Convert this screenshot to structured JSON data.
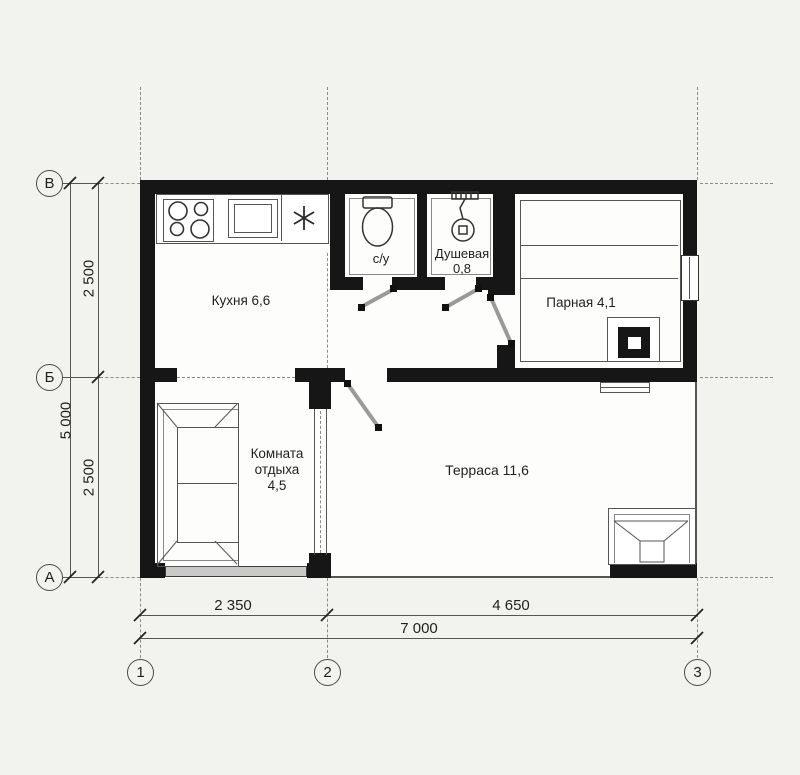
{
  "colors": {
    "wall": "#161616",
    "line": "#555555",
    "bg": "#f2f2ef",
    "paper": "#fdfdfc",
    "ink": "#1f1f1f",
    "glass": "#c9c9c6"
  },
  "rooms": {
    "kitchen": {
      "label": "Кухня 6,6"
    },
    "wc": {
      "label": "с/у"
    },
    "shower": {
      "name": "Душевая",
      "area": "0,8"
    },
    "steam": {
      "label": "Парная 4,1"
    },
    "lounge": {
      "name": "Комната",
      "name2": "отдыха",
      "area": "4,5"
    },
    "terrace": {
      "label": "Терраса 11,6"
    }
  },
  "grid": {
    "rows": [
      "В",
      "Б",
      "А"
    ],
    "cols": [
      "1",
      "2",
      "3"
    ]
  },
  "dimensions": {
    "left_inner": [
      "2 500",
      "2 500"
    ],
    "left_outer": "5 000",
    "bottom_inner": [
      "2 350",
      "4 650"
    ],
    "bottom_outer": "7 000"
  }
}
